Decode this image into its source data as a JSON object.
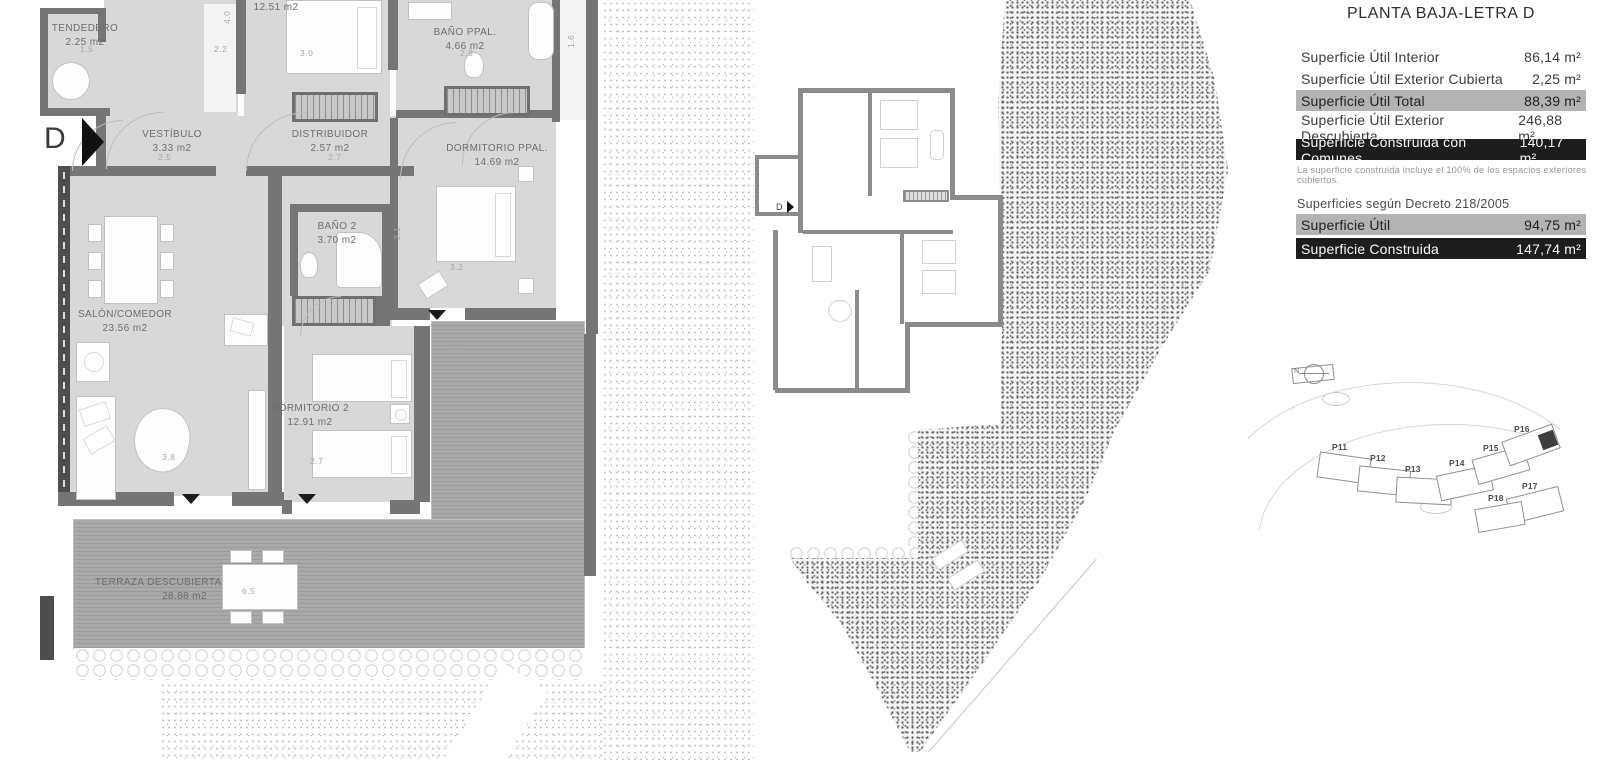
{
  "sheet": {
    "unit_letter": "D"
  },
  "plan": {
    "rooms": [
      {
        "name": "TENDEDERO",
        "area": "2.25 m2"
      },
      {
        "name": "",
        "area": "12.51 m2"
      },
      {
        "name": "BAÑO PPAL.",
        "area": "4.66 m2"
      },
      {
        "name": "VESTÍBULO",
        "area": "3.33 m2"
      },
      {
        "name": "DISTRIBUIDOR",
        "area": "2.57 m2"
      },
      {
        "name": "DORMITORIO PPAL.",
        "area": "14.69 m2"
      },
      {
        "name": "BAÑO 2",
        "area": "3.70 m2"
      },
      {
        "name": "SALÓN/COMEDOR",
        "area": "23.56 m2"
      },
      {
        "name": "DORMITORIO 2",
        "area": "12.91 m2"
      },
      {
        "name": "TERRAZA DESCUBIERTA",
        "area": "28.88 m2"
      }
    ],
    "dims": [
      "1.5",
      "2.2",
      "3.0",
      "2.8",
      "1.6",
      "4.0",
      "2.5",
      "2.7",
      "3.2",
      "2.1",
      "2.3",
      "3.8",
      "2.7",
      "9.4",
      "6.5"
    ]
  },
  "mini_plan": {
    "unit_letter": "D"
  },
  "panel": {
    "title": "PLANTA BAJA-LETRA D",
    "table": {
      "rows": [
        {
          "label": "Superficie Útil Interior",
          "value": "86,14 m²",
          "style": "plain"
        },
        {
          "label": "Superficie Útil Exterior Cubierta",
          "value": "2,25 m²",
          "style": "plain"
        },
        {
          "label": "Superficie Útil Total",
          "value": "88,39 m²",
          "style": "gray"
        },
        {
          "label": "Superficie Útil Exterior Descubierta",
          "value": "246,88 m²",
          "style": "plain"
        },
        {
          "label": "Superficie Construida con Comunes",
          "value": "140,17 m²",
          "style": "dark"
        }
      ],
      "note": "La superficie construida incluye el 100% de los espacios exteriores cubiertos."
    },
    "decree": {
      "heading": "Superficies según Decreto 218/2005",
      "rows": [
        {
          "label": "Superficie Útil",
          "value": "94,75 m²",
          "style": "gray"
        },
        {
          "label": "Superficie Construida",
          "value": "147,74 m²",
          "style": "dark"
        }
      ]
    },
    "site": {
      "north_label": "N",
      "buildings": [
        "P11",
        "P12",
        "P13",
        "P14",
        "P15",
        "P16",
        "P17",
        "P18"
      ],
      "highlighted": "P16"
    }
  },
  "colors": {
    "wall": "#757575",
    "room_fill": "#d8d8d8",
    "highlight_gray": "#b3b3b3",
    "highlight_dark": "#1d1d1d",
    "door_marker": "#1c1c1c"
  }
}
